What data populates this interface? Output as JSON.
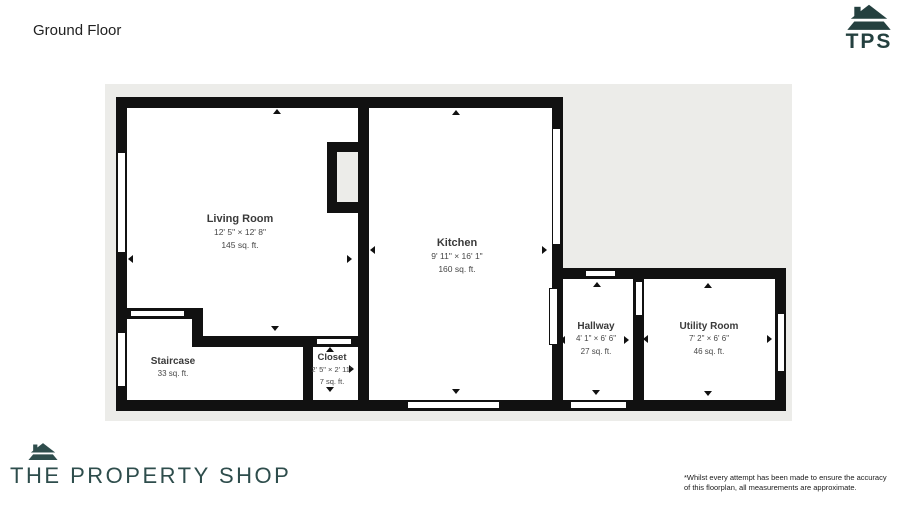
{
  "header": {
    "title": "Ground Floor"
  },
  "brand": {
    "tps_text": "TPS",
    "logo_text": "THE PROPERTY SHOP"
  },
  "rooms": {
    "living_room": {
      "name": "Living Room",
      "dimensions": "12' 5\" × 12' 8\"",
      "area": "145 sq. ft."
    },
    "kitchen": {
      "name": "Kitchen",
      "dimensions": "9' 11\" × 16' 1\"",
      "area": "160 sq. ft."
    },
    "staircase": {
      "name": "Staircase",
      "area": "33 sq. ft."
    },
    "closet": {
      "name": "Closet",
      "dimensions": "2' 5\" × 2' 11\"",
      "area": "7 sq. ft."
    },
    "hallway": {
      "name": "Hallway",
      "dimensions": "4' 1\" × 6' 6\"",
      "area": "27 sq. ft."
    },
    "utility_room": {
      "name": "Utility Room",
      "dimensions": "7' 2\" × 6' 6\"",
      "area": "46 sq. ft."
    }
  },
  "footer": {
    "disclaimer_line1": "*Whilst every attempt has been made to ensure the accuracy",
    "disclaimer_line2": "of this floorplan, all measurements are approximate."
  },
  "colors": {
    "wall": "#111111",
    "plan_background": "#ECECE9",
    "brand_teal": "#24403F",
    "room_fill": "#FFFFFF"
  }
}
